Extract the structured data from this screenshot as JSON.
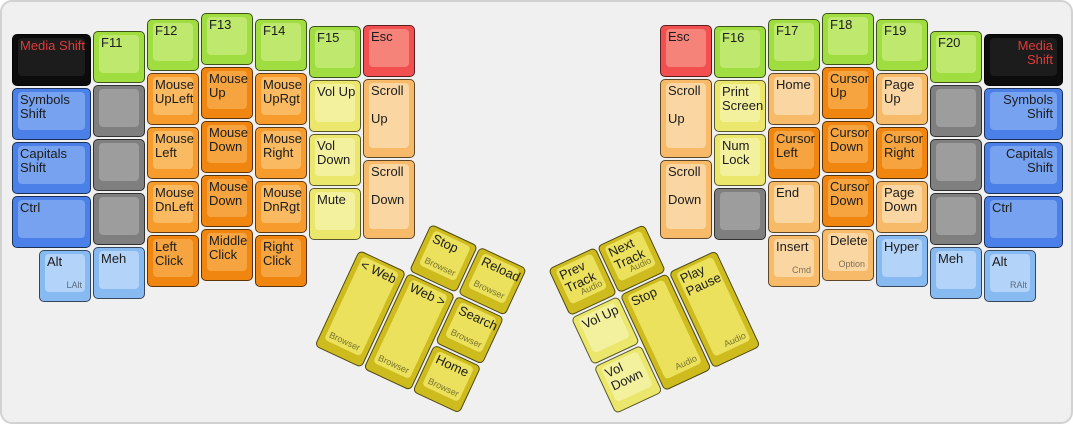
{
  "window": {
    "background": "#f0f0f0",
    "frame_border": "#d2d2d2"
  },
  "text": {
    "default": "#1c1c1c",
    "media_shift": "#e03a3a",
    "sub": "rgba(0,0,0,0.5)"
  },
  "unit": 54,
  "palette": {
    "green": {
      "base": "#a0dd40",
      "top": "#bee96e"
    },
    "red": {
      "base": "#f25050",
      "top": "#f5837a"
    },
    "blue": {
      "base": "#4a80e8",
      "top": "#76a2f0"
    },
    "lightblue": {
      "base": "#88baf2",
      "top": "#b3d4f8"
    },
    "gray": {
      "base": "#7f7f7f",
      "top": "#9d9d9d"
    },
    "black": {
      "base": "#0c0c0c",
      "top": "#1c1c1c"
    },
    "yellow": {
      "base": "#ebe76d",
      "top": "#f4f19e"
    },
    "peach": {
      "base": "#f7ba69",
      "top": "#fad7a2"
    },
    "orange": {
      "base": "#f69b2c",
      "top": "#f9ba62"
    },
    "dkorange": {
      "base": "#f0860f",
      "top": "#f5a440"
    },
    "gold": {
      "base": "#cebc1e",
      "top": "#ebe15c"
    }
  },
  "keys_main": [
    {
      "id": "media-shift-left",
      "label": "Media Shift",
      "color": "black",
      "x": 10,
      "y": 32,
      "w": 81,
      "tc": "media_shift"
    },
    {
      "id": "symbols-shift-left",
      "label": "Symbols Shift",
      "color": "blue",
      "x": 10,
      "y": 86,
      "w": 81
    },
    {
      "id": "capitals-shift-left",
      "label": "Capitals Shift",
      "color": "blue",
      "x": 10,
      "y": 140,
      "w": 81
    },
    {
      "id": "ctrl-left",
      "label": "Ctrl",
      "color": "blue",
      "x": 10,
      "y": 194,
      "w": 81
    },
    {
      "id": "alt-left",
      "label": "Alt",
      "sub": "LAlt",
      "color": "lightblue",
      "x": 37,
      "y": 248
    },
    {
      "id": "f11",
      "label": "F11",
      "color": "green",
      "x": 91,
      "y": 29
    },
    {
      "id": "blank-l1",
      "color": "gray",
      "x": 91,
      "y": 83
    },
    {
      "id": "blank-l2",
      "color": "gray",
      "x": 91,
      "y": 137
    },
    {
      "id": "blank-l3",
      "color": "gray",
      "x": 91,
      "y": 191
    },
    {
      "id": "meh-left",
      "label": "Meh",
      "color": "lightblue",
      "x": 91,
      "y": 245
    },
    {
      "id": "f12",
      "label": "F12",
      "color": "green",
      "x": 145,
      "y": 17
    },
    {
      "id": "mouse-upleft",
      "label": "Mouse UpLeft",
      "color": "orange",
      "x": 145,
      "y": 71
    },
    {
      "id": "mouse-left",
      "label": "Mouse Left",
      "color": "orange",
      "x": 145,
      "y": 125
    },
    {
      "id": "mouse-dnleft",
      "label": "Mouse DnLeft",
      "color": "orange",
      "x": 145,
      "y": 179
    },
    {
      "id": "left-click",
      "label": "Left Click",
      "color": "dkorange",
      "x": 145,
      "y": 233
    },
    {
      "id": "f13",
      "label": "F13",
      "color": "green",
      "x": 199,
      "y": 11
    },
    {
      "id": "mouse-up",
      "label": "Mouse Up",
      "color": "dkorange",
      "x": 199,
      "y": 65
    },
    {
      "id": "mouse-down",
      "label": "Mouse Down",
      "color": "dkorange",
      "x": 199,
      "y": 119
    },
    {
      "id": "mouse-down-2",
      "label": "Mouse Down",
      "color": "dkorange",
      "x": 199,
      "y": 173
    },
    {
      "id": "middle-click",
      "label": "Middle Click",
      "color": "dkorange",
      "x": 199,
      "y": 227
    },
    {
      "id": "f14",
      "label": "F14",
      "color": "green",
      "x": 253,
      "y": 17
    },
    {
      "id": "mouse-uprgt",
      "label": "Mouse UpRgt",
      "color": "orange",
      "x": 253,
      "y": 71
    },
    {
      "id": "mouse-right",
      "label": "Mouse Right",
      "color": "orange",
      "x": 253,
      "y": 125
    },
    {
      "id": "mouse-dnrgt",
      "label": "Mouse DnRgt",
      "color": "orange",
      "x": 253,
      "y": 179
    },
    {
      "id": "right-click",
      "label": "Right Click",
      "color": "dkorange",
      "x": 253,
      "y": 233
    },
    {
      "id": "f15",
      "label": "F15",
      "color": "green",
      "x": 307,
      "y": 24
    },
    {
      "id": "vol-up-left",
      "label": "Vol Up",
      "color": "yellow",
      "x": 307,
      "y": 78
    },
    {
      "id": "vol-down-left",
      "label": "Vol Down",
      "color": "yellow",
      "x": 307,
      "y": 132
    },
    {
      "id": "mute",
      "label": "Mute",
      "color": "yellow",
      "x": 307,
      "y": 186
    },
    {
      "id": "esc-left",
      "label": "Esc",
      "color": "red",
      "x": 361,
      "y": 23
    },
    {
      "id": "scroll-up-left",
      "label": "Scroll\n\nUp",
      "color": "peach",
      "x": 361,
      "y": 77,
      "h": 81
    },
    {
      "id": "scroll-down-left",
      "label": "Scroll\n\nDown",
      "color": "peach",
      "x": 361,
      "y": 158,
      "h": 81
    },
    {
      "id": "esc-right",
      "label": "Esc",
      "color": "red",
      "x": 658,
      "y": 23
    },
    {
      "id": "scroll-up-right",
      "label": "Scroll\n\nUp",
      "color": "peach",
      "x": 658,
      "y": 77,
      "h": 81
    },
    {
      "id": "scroll-down-right",
      "label": "Scroll\n\nDown",
      "color": "peach",
      "x": 658,
      "y": 158,
      "h": 81
    },
    {
      "id": "f16",
      "label": "F16",
      "color": "green",
      "x": 712,
      "y": 24
    },
    {
      "id": "print-screen",
      "label": "Print Screen",
      "color": "yellow",
      "x": 712,
      "y": 78
    },
    {
      "id": "num-lock",
      "label": "Num Lock",
      "color": "yellow",
      "x": 712,
      "y": 132
    },
    {
      "id": "blank-r1",
      "color": "gray",
      "x": 712,
      "y": 186
    },
    {
      "id": "f17",
      "label": "F17",
      "color": "green",
      "x": 766,
      "y": 17
    },
    {
      "id": "home-key",
      "label": "Home",
      "color": "peach",
      "x": 766,
      "y": 71
    },
    {
      "id": "cursor-left",
      "label": "Cursor Left",
      "color": "dkorange",
      "x": 766,
      "y": 125
    },
    {
      "id": "end-key",
      "label": "End",
      "color": "peach",
      "x": 766,
      "y": 179
    },
    {
      "id": "insert-key",
      "label": "Insert",
      "sub": "Cmd",
      "color": "peach",
      "x": 766,
      "y": 233
    },
    {
      "id": "f18",
      "label": "F18",
      "color": "green",
      "x": 820,
      "y": 11
    },
    {
      "id": "cursor-up",
      "label": "Cursor Up",
      "color": "dkorange",
      "x": 820,
      "y": 65
    },
    {
      "id": "cursor-down",
      "label": "Cursor Down",
      "color": "dkorange",
      "x": 820,
      "y": 119
    },
    {
      "id": "cursor-down-2",
      "label": "Cursor Down",
      "color": "dkorange",
      "x": 820,
      "y": 173
    },
    {
      "id": "delete-key",
      "label": "Delete",
      "sub": "Option",
      "color": "peach",
      "x": 820,
      "y": 227
    },
    {
      "id": "f19",
      "label": "F19",
      "color": "green",
      "x": 874,
      "y": 17
    },
    {
      "id": "page-up",
      "label": "Page Up",
      "color": "peach",
      "x": 874,
      "y": 71
    },
    {
      "id": "cursor-right",
      "label": "Cursor Right",
      "color": "dkorange",
      "x": 874,
      "y": 125
    },
    {
      "id": "page-down",
      "label": "Page Down",
      "color": "peach",
      "x": 874,
      "y": 179
    },
    {
      "id": "hyper",
      "label": "Hyper",
      "color": "lightblue",
      "x": 874,
      "y": 233
    },
    {
      "id": "f20",
      "label": "F20",
      "color": "green",
      "x": 928,
      "y": 29
    },
    {
      "id": "blank-r2",
      "color": "gray",
      "x": 928,
      "y": 83
    },
    {
      "id": "blank-r3",
      "color": "gray",
      "x": 928,
      "y": 137
    },
    {
      "id": "blank-r4",
      "color": "gray",
      "x": 928,
      "y": 191
    },
    {
      "id": "meh-right",
      "label": "Meh",
      "color": "lightblue",
      "x": 928,
      "y": 245
    },
    {
      "id": "media-shift-right",
      "label": "Media Shift",
      "color": "black",
      "x": 982,
      "y": 32,
      "w": 81,
      "tc": "media_shift",
      "align": "right"
    },
    {
      "id": "symbols-shift-right",
      "label": "Symbols Shift",
      "color": "blue",
      "x": 982,
      "y": 86,
      "w": 81,
      "align": "right"
    },
    {
      "id": "capitals-shift-right",
      "label": "Capitals Shift",
      "color": "blue",
      "x": 982,
      "y": 140,
      "w": 81,
      "align": "right"
    },
    {
      "id": "ctrl-right",
      "label": "Ctrl",
      "color": "blue",
      "x": 982,
      "y": 194,
      "w": 81
    },
    {
      "id": "alt-right",
      "label": "Alt",
      "sub": "RAlt",
      "color": "lightblue",
      "x": 982,
      "y": 248
    }
  ],
  "thumb_clusters": [
    {
      "id": "left-thumb",
      "x": 380,
      "y": 199,
      "rotation": 25,
      "keys": [
        {
          "id": "stop-browser",
          "label": "Stop",
          "sub": "Browser",
          "color": "gold",
          "x": 54,
          "y": 0
        },
        {
          "id": "reload-browser",
          "label": "Reload",
          "sub": "Browser",
          "color": "gold",
          "x": 108,
          "y": 0
        },
        {
          "id": "web-back",
          "label": "< Web",
          "sub": "Browser",
          "sub_pos": "bl",
          "color": "gold",
          "x": 0,
          "y": 54,
          "h": 108
        },
        {
          "id": "web-forward",
          "label": "Web >",
          "sub": "Browser",
          "sub_pos": "bl",
          "color": "gold",
          "x": 54,
          "y": 54,
          "h": 108
        },
        {
          "id": "search-browser",
          "label": "Search",
          "sub": "Browser",
          "color": "gold",
          "x": 108,
          "y": 54
        },
        {
          "id": "home-browser",
          "label": "Home",
          "sub": "Browser",
          "color": "gold",
          "x": 108,
          "y": 108
        }
      ]
    },
    {
      "id": "right-thumb",
      "x": 546,
      "y": 267,
      "rotation": -25,
      "keys": [
        {
          "id": "prev-track",
          "label": "Prev Track",
          "sub": "Audio",
          "color": "gold",
          "x": 0,
          "y": 0
        },
        {
          "id": "next-track",
          "label": "Next Track",
          "sub": "Audio",
          "color": "gold",
          "x": 54,
          "y": 0
        },
        {
          "id": "vol-up-thumb",
          "label": "Vol Up",
          "color": "yellow",
          "x": 0,
          "y": 54
        },
        {
          "id": "stop-audio",
          "label": "Stop",
          "sub": "Audio",
          "color": "gold",
          "x": 54,
          "y": 54,
          "h": 108
        },
        {
          "id": "play-pause",
          "label": "Play Pause",
          "sub": "Audio",
          "color": "gold",
          "x": 108,
          "y": 54,
          "h": 108
        },
        {
          "id": "vol-down-thumb",
          "label": "Vol Down",
          "color": "yellow",
          "x": 0,
          "y": 108
        }
      ]
    }
  ]
}
